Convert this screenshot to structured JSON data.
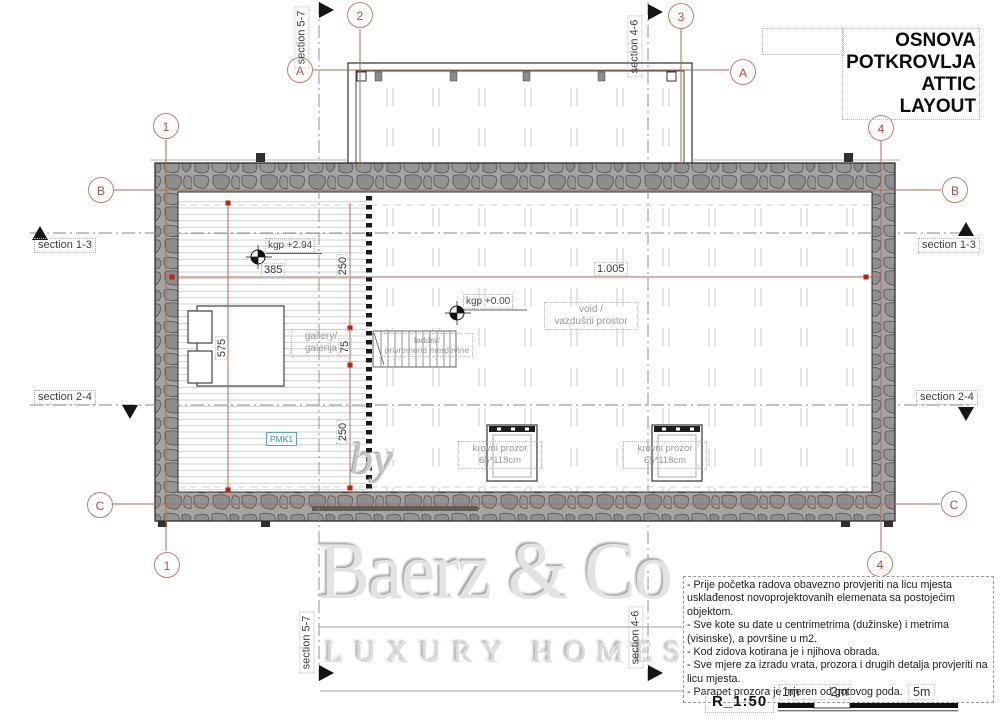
{
  "drawing_title": {
    "line1": "OSNOVA",
    "line2": "POTKROVLJA",
    "line3": "ATTIC LAYOUT"
  },
  "grid_bubbles": {
    "one": "1",
    "two": "2",
    "three": "3",
    "four": "4",
    "a": "A",
    "b": "B",
    "c": "C"
  },
  "section_labels": {
    "s13": "section 1-3",
    "s24": "section 2-4",
    "s57": "section 5-7",
    "s46": "section 4-6"
  },
  "dimensions": {
    "total": "1.005",
    "gallery_width": "385",
    "d250_upper": "250",
    "gallery_depth": "575",
    "d75": "75",
    "d250_lower": "250"
  },
  "level_marks": {
    "gallery_level": "kgp +2.94",
    "floor_level": "kgp +0.00"
  },
  "room_labels": {
    "void_line1": "void /",
    "void_line2": "vazdušni prostor",
    "gallery_line1": "gallery/",
    "gallery_line2": "galerija",
    "ladder_line1": "ladder/",
    "ladder_line2": "privremene merdevine",
    "roof_window_line1": "krovni prozor",
    "roof_window_line2": "65*118cm",
    "pmk_tag": "PMK1"
  },
  "watermark": {
    "by": "by",
    "brand": "Baerz & Co",
    "tagline": "LUXURY HOMES"
  },
  "notes": {
    "items": [
      "- Prije početka radova obavezno provjeriti na licu mjesta usklađenost novoprojektovanih elemenata sa postojećim objektom.",
      "- Sve kote su date u centrimetrima (dužinske) i metrima (visinske), a površine u m2.",
      "- Kod zidova kotirana je i njihova obrada.",
      "- Sve mjere za izradu vrata, prozora i drugih detalja provjeriti na licu mjesta.",
      "- Parapet prozora je mjeren od gotovog poda."
    ]
  },
  "scale_bar": {
    "ratio": "R_1:50",
    "mark_1m": "1m",
    "mark_2m": "2m",
    "mark_5m": "5m"
  },
  "colors": {
    "grid_accent": "#b26a55",
    "dot_red": "#c3200a",
    "wall_gray": "#a4a4a4",
    "label_gray": "#9a9a9a",
    "pmk_blue": "#2e8fae",
    "watermark_gray": "#e3e3e3"
  }
}
